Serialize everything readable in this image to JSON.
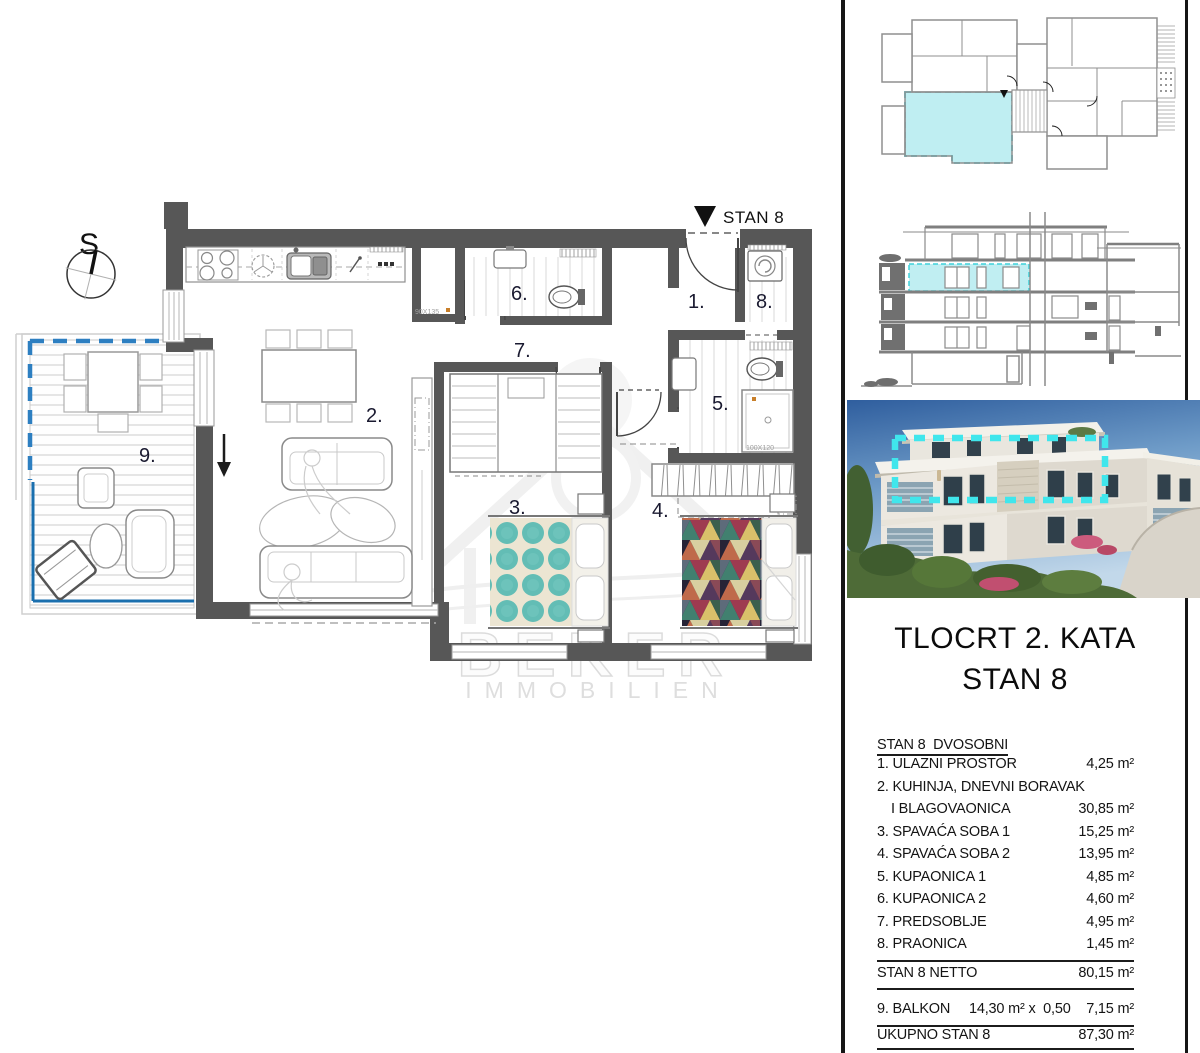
{
  "plan": {
    "compass_letter": "S",
    "entrance_marker": "STAN 8",
    "labels": {
      "r1": "1.",
      "r2": "2.",
      "r3": "3.",
      "r4": "4.",
      "r5": "5.",
      "r6": "6.",
      "r7": "7.",
      "r8": "8.",
      "r9": "9."
    },
    "dims": {
      "niche": "90X135",
      "shower": "100X120"
    },
    "watermark": {
      "brand": "BEKER",
      "sub": "IMMOBILIEN"
    }
  },
  "sidebar": {
    "title": {
      "line1": "TLOCRT 2. KATA",
      "line2": "STAN 8"
    },
    "area_table": {
      "header": "STAN 8  DVOSOBNI",
      "rows": [
        {
          "label": "1. ULAZNI PROSTOR",
          "value": "4,25 m²"
        },
        {
          "label": "2. KUHINJA, DNEVNI BORAVAK",
          "value": ""
        },
        {
          "label": "I BLAGOVAONICA",
          "value": "30,85 m²"
        },
        {
          "label": "3. SPAVAĆA SOBA 1",
          "value": "15,25 m²"
        },
        {
          "label": "4. SPAVAĆA SOBA 2",
          "value": "13,95 m²"
        },
        {
          "label": "5. KUPAONICA 1",
          "value": "4,85 m²"
        },
        {
          "label": "6. KUPAONICA 2",
          "value": "4,60 m²"
        },
        {
          "label": "7. PREDSOBLJE",
          "value": "4,95 m²"
        },
        {
          "label": "8. PRAONICA",
          "value": "1,45 m²"
        }
      ],
      "netto": {
        "label": "STAN 8 NETTO",
        "value": "80,15 m²"
      },
      "balcony": {
        "label": "9. BALKON",
        "formula": "14,30 m² x  0,50",
        "value": "7,15 m²"
      },
      "total": {
        "label": "UKUPNO STAN 8",
        "value": "87,30 m²"
      }
    }
  },
  "colors": {
    "unit_highlight_fill": "#bfeef2",
    "unit_highlight_stroke": "#35cbd6",
    "photo_marker_dash": "#40e6ec",
    "balcony_line_blue": "#1a6fae",
    "balcony_dash_blue": "#2d7fc1",
    "wall_gray": "#575757",
    "detail_orange": "#c87f2a",
    "bed_teal": "#63bdb5"
  }
}
